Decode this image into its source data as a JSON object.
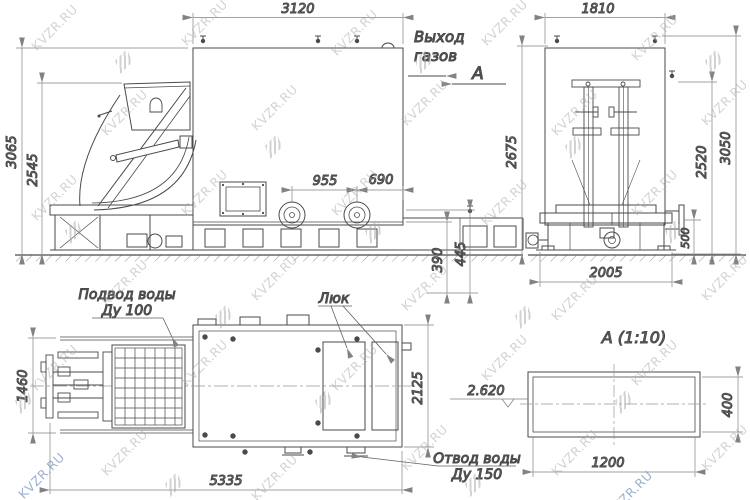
{
  "watermark": {
    "text": "KVZR.RU",
    "color": "#a9a9a9",
    "accent_color": "#7f95c2"
  },
  "views": {
    "front": {
      "dims": {
        "overall_width": "3120",
        "overall_height": "3065",
        "hopper_height": "2545",
        "flange_pitch": "955",
        "flange_offset": "690",
        "pit_depth_1": "390",
        "pit_depth_2": "445"
      },
      "labels": {
        "gas_out_line1": "Выход",
        "gas_out_line2": "газов",
        "section_mark": "А"
      }
    },
    "side": {
      "dims": {
        "top_width": "1810",
        "left_height": "2675",
        "right_inner_height": "2520",
        "right_outer_height": "3050",
        "nozzle_height": "500",
        "base_width": "2005"
      }
    },
    "plan": {
      "dims": {
        "grate_width": "1460",
        "body_width": "2125",
        "total_length": "5335"
      },
      "labels": {
        "water_supply_line1": "Подвод воды",
        "water_supply_line2": "Ду 100",
        "hatch": "Люк",
        "water_drain_line1": "Отвод воды",
        "water_drain_line2": "Ду 150"
      }
    },
    "detail": {
      "title": "А  (1:10)",
      "dims": {
        "length": "1200",
        "height": "400",
        "elevation": "2.620"
      }
    }
  }
}
